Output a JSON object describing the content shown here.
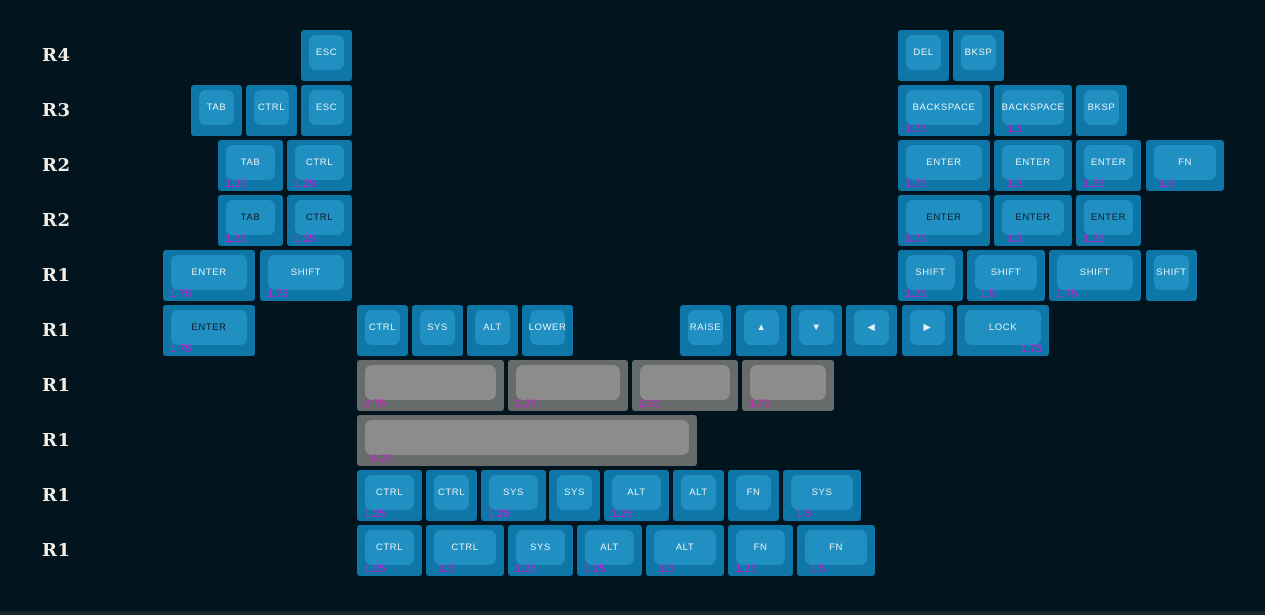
{
  "canvas": {
    "width": 1265,
    "height": 615,
    "background_color": "#02141e",
    "bottom_bar_color": "#18262f"
  },
  "colors": {
    "key_base_blue": "#0f76a8",
    "key_top_blue": "#2090c2",
    "key_base_gray": "#686b6b",
    "key_top_gray": "#8c8c8a",
    "legend_light": "#e8f2f6",
    "legend_dark": "#0a1c28",
    "size_label_magenta": "#d31ad8",
    "row_label_color": "#f2eee6"
  },
  "row_labels": [
    {
      "text": "R4",
      "y": 30
    },
    {
      "text": "R3",
      "y": 85
    },
    {
      "text": "R2",
      "y": 140
    },
    {
      "text": "R2",
      "y": 195
    },
    {
      "text": "R1",
      "y": 250
    },
    {
      "text": "R1",
      "y": 305
    },
    {
      "text": "R1",
      "y": 360
    },
    {
      "text": "R1",
      "y": 415
    },
    {
      "text": "R1",
      "y": 470
    },
    {
      "text": "R1",
      "y": 525
    }
  ],
  "keys": [
    {
      "name": "keycap-esc",
      "label": "ESC",
      "x": 301,
      "y": 30,
      "w": 51,
      "style": "blue",
      "legend": "light",
      "size": ""
    },
    {
      "name": "keycap-del",
      "label": "DEL",
      "x": 898,
      "y": 30,
      "w": 51,
      "style": "blue",
      "legend": "light",
      "size": ""
    },
    {
      "name": "keycap-bksp",
      "label": "BKSP",
      "x": 953,
      "y": 30,
      "w": 51,
      "style": "blue",
      "legend": "light",
      "size": ""
    },
    {
      "name": "keycap-tab",
      "label": "TAB",
      "x": 191,
      "y": 85,
      "w": 51,
      "style": "blue",
      "legend": "light",
      "size": ""
    },
    {
      "name": "keycap-ctrl",
      "label": "CTRL",
      "x": 246,
      "y": 85,
      "w": 51,
      "style": "blue",
      "legend": "light",
      "size": ""
    },
    {
      "name": "keycap-esc",
      "label": "ESC",
      "x": 301,
      "y": 85,
      "w": 51,
      "style": "blue",
      "legend": "light",
      "size": ""
    },
    {
      "name": "keycap-backspace",
      "label": "BACKSPACE",
      "x": 898,
      "y": 85,
      "w": 92,
      "style": "blue",
      "legend": "light",
      "size": "1.75"
    },
    {
      "name": "keycap-backspace",
      "label": "BACKSPACE",
      "x": 994,
      "y": 85,
      "w": 78,
      "style": "blue",
      "legend": "light",
      "size": "1.5",
      "size_dx": 13
    },
    {
      "name": "keycap-bksp",
      "label": "BKSP",
      "x": 1076,
      "y": 85,
      "w": 51,
      "style": "blue",
      "legend": "light",
      "size": ""
    },
    {
      "name": "keycap-tab",
      "label": "TAB",
      "x": 218,
      "y": 140,
      "w": 65,
      "style": "blue",
      "legend": "light",
      "size": "1.25"
    },
    {
      "name": "keycap-ctrl",
      "label": "CTRL",
      "x": 287,
      "y": 140,
      "w": 65,
      "style": "blue",
      "legend": "light",
      "size": "1.25"
    },
    {
      "name": "keycap-enter",
      "label": "ENTER",
      "x": 898,
      "y": 140,
      "w": 92,
      "style": "blue",
      "legend": "light",
      "size": "1.75"
    },
    {
      "name": "keycap-enter",
      "label": "ENTER",
      "x": 994,
      "y": 140,
      "w": 78,
      "style": "blue",
      "legend": "light",
      "size": "1.5",
      "size_dx": 13
    },
    {
      "name": "keycap-enter",
      "label": "ENTER",
      "x": 1076,
      "y": 140,
      "w": 65,
      "style": "blue",
      "legend": "light",
      "size": "1.25"
    },
    {
      "name": "keycap-fn",
      "label": "FN",
      "x": 1146,
      "y": 140,
      "w": 78,
      "style": "blue",
      "legend": "light",
      "size": "1.5",
      "size_dx": 13
    },
    {
      "name": "keycap-tab",
      "label": "TAB",
      "x": 218,
      "y": 195,
      "w": 65,
      "style": "blue",
      "legend": "dark",
      "size": "1.25"
    },
    {
      "name": "keycap-ctrl",
      "label": "CTRL",
      "x": 287,
      "y": 195,
      "w": 65,
      "style": "blue",
      "legend": "dark",
      "size": "1.25"
    },
    {
      "name": "keycap-enter",
      "label": "ENTER",
      "x": 898,
      "y": 195,
      "w": 92,
      "style": "blue",
      "legend": "dark",
      "size": "1.75"
    },
    {
      "name": "keycap-enter",
      "label": "ENTER",
      "x": 994,
      "y": 195,
      "w": 78,
      "style": "blue",
      "legend": "dark",
      "size": "1.5",
      "size_dx": 13
    },
    {
      "name": "keycap-enter",
      "label": "ENTER",
      "x": 1076,
      "y": 195,
      "w": 65,
      "style": "blue",
      "legend": "dark",
      "size": "1.25"
    },
    {
      "name": "keycap-enter",
      "label": "ENTER",
      "x": 163,
      "y": 250,
      "w": 92,
      "style": "blue",
      "legend": "light",
      "size": "1.75"
    },
    {
      "name": "keycap-shift",
      "label": "SHIFT",
      "x": 260,
      "y": 250,
      "w": 92,
      "style": "blue",
      "legend": "light",
      "size": "1.75"
    },
    {
      "name": "keycap-shift",
      "label": "SHIFT",
      "x": 898,
      "y": 250,
      "w": 65,
      "style": "blue",
      "legend": "light",
      "size": "1.25"
    },
    {
      "name": "keycap-shift",
      "label": "SHIFT",
      "x": 967,
      "y": 250,
      "w": 78,
      "style": "blue",
      "legend": "light",
      "size": "1.5",
      "size_dx": 13
    },
    {
      "name": "keycap-shift",
      "label": "SHIFT",
      "x": 1049,
      "y": 250,
      "w": 92,
      "style": "blue",
      "legend": "light",
      "size": "1.75"
    },
    {
      "name": "keycap-shift",
      "label": "SHIFT",
      "x": 1146,
      "y": 250,
      "w": 51,
      "style": "blue",
      "legend": "light",
      "size": ""
    },
    {
      "name": "keycap-enter",
      "label": "ENTER",
      "x": 163,
      "y": 305,
      "w": 92,
      "style": "blue",
      "legend": "dark",
      "size": "1.75"
    },
    {
      "name": "keycap-ctrl",
      "label": "CTRL",
      "x": 357,
      "y": 305,
      "w": 51,
      "style": "blue",
      "legend": "light",
      "size": ""
    },
    {
      "name": "keycap-sys",
      "label": "SYS",
      "x": 412,
      "y": 305,
      "w": 51,
      "style": "blue",
      "legend": "light",
      "size": ""
    },
    {
      "name": "keycap-alt",
      "label": "ALT",
      "x": 467,
      "y": 305,
      "w": 51,
      "style": "blue",
      "legend": "light",
      "size": ""
    },
    {
      "name": "keycap-lower",
      "label": "LOWER",
      "x": 522,
      "y": 305,
      "w": 51,
      "style": "blue",
      "legend": "light",
      "size": ""
    },
    {
      "name": "keycap-raise",
      "label": "RAISE",
      "x": 680,
      "y": 305,
      "w": 51,
      "style": "blue",
      "legend": "light",
      "size": ""
    },
    {
      "name": "keycap-arrow-up",
      "label": "▲",
      "x": 736,
      "y": 305,
      "w": 51,
      "style": "blue",
      "legend": "light",
      "size": ""
    },
    {
      "name": "keycap-arrow-down",
      "label": "▼",
      "x": 791,
      "y": 305,
      "w": 51,
      "style": "blue",
      "legend": "light",
      "size": ""
    },
    {
      "name": "keycap-arrow-left",
      "label": "◀",
      "x": 846,
      "y": 305,
      "w": 51,
      "style": "blue",
      "legend": "light",
      "size": ""
    },
    {
      "name": "keycap-arrow-right",
      "label": "▶",
      "x": 902,
      "y": 305,
      "w": 51,
      "style": "blue",
      "legend": "light",
      "size": ""
    },
    {
      "name": "keycap-lock",
      "label": "LOCK",
      "x": 957,
      "y": 305,
      "w": 92,
      "style": "blue",
      "legend": "light",
      "size": "1.75",
      "size_align": "right"
    },
    {
      "name": "keycap-spacebar",
      "label": "",
      "x": 357,
      "y": 360,
      "w": 147,
      "style": "gray",
      "legend": "light",
      "size": "2.75"
    },
    {
      "name": "keycap-spacebar",
      "label": "",
      "x": 508,
      "y": 360,
      "w": 120,
      "style": "gray",
      "legend": "light",
      "size": "2.25"
    },
    {
      "name": "keycap-spacebar",
      "label": "",
      "x": 632,
      "y": 360,
      "w": 106,
      "style": "gray",
      "legend": "light",
      "size": "2.00"
    },
    {
      "name": "keycap-spacebar",
      "label": "",
      "x": 742,
      "y": 360,
      "w": 92,
      "style": "gray",
      "legend": "light",
      "size": "1.75"
    },
    {
      "name": "keycap-spacebar",
      "label": "",
      "x": 357,
      "y": 415,
      "w": 340,
      "style": "gray",
      "legend": "light",
      "size": "6.25",
      "size_dx": 14
    },
    {
      "name": "keycap-ctrl",
      "label": "CTRL",
      "x": 357,
      "y": 470,
      "w": 65,
      "style": "blue",
      "legend": "light",
      "size": "1.25"
    },
    {
      "name": "keycap-ctrl",
      "label": "CTRL",
      "x": 426,
      "y": 470,
      "w": 51,
      "style": "blue",
      "legend": "light",
      "size": ""
    },
    {
      "name": "keycap-sys",
      "label": "SYS",
      "x": 481,
      "y": 470,
      "w": 65,
      "style": "blue",
      "legend": "light",
      "size": "1.25"
    },
    {
      "name": "keycap-sys",
      "label": "SYS",
      "x": 549,
      "y": 470,
      "w": 51,
      "style": "blue",
      "legend": "light",
      "size": ""
    },
    {
      "name": "keycap-alt",
      "label": "ALT",
      "x": 604,
      "y": 470,
      "w": 65,
      "style": "blue",
      "legend": "light",
      "size": "1.25"
    },
    {
      "name": "keycap-alt",
      "label": "ALT",
      "x": 673,
      "y": 470,
      "w": 51,
      "style": "blue",
      "legend": "light",
      "size": ""
    },
    {
      "name": "keycap-fn",
      "label": "FN",
      "x": 728,
      "y": 470,
      "w": 51,
      "style": "blue",
      "legend": "light",
      "size": ""
    },
    {
      "name": "keycap-sys",
      "label": "SYS",
      "x": 783,
      "y": 470,
      "w": 78,
      "style": "blue",
      "legend": "light",
      "size": "1.5",
      "size_dx": 13
    },
    {
      "name": "keycap-ctrl",
      "label": "CTRL",
      "x": 357,
      "y": 525,
      "w": 65,
      "style": "blue",
      "legend": "light",
      "size": "1.25"
    },
    {
      "name": "keycap-ctrl",
      "label": "CTRL",
      "x": 426,
      "y": 525,
      "w": 78,
      "style": "blue",
      "legend": "light",
      "size": "1.5",
      "size_dx": 13
    },
    {
      "name": "keycap-sys",
      "label": "SYS",
      "x": 508,
      "y": 525,
      "w": 65,
      "style": "blue",
      "legend": "light",
      "size": "1.25"
    },
    {
      "name": "keycap-alt",
      "label": "ALT",
      "x": 577,
      "y": 525,
      "w": 65,
      "style": "blue",
      "legend": "light",
      "size": "1.25"
    },
    {
      "name": "keycap-alt",
      "label": "ALT",
      "x": 646,
      "y": 525,
      "w": 78,
      "style": "blue",
      "legend": "light",
      "size": "1.5",
      "size_dx": 13
    },
    {
      "name": "keycap-fn",
      "label": "FN",
      "x": 728,
      "y": 525,
      "w": 65,
      "style": "blue",
      "legend": "light",
      "size": "1.25"
    },
    {
      "name": "keycap-fn",
      "label": "FN",
      "x": 797,
      "y": 525,
      "w": 78,
      "style": "blue",
      "legend": "light",
      "size": "1.5",
      "size_dx": 13
    }
  ]
}
